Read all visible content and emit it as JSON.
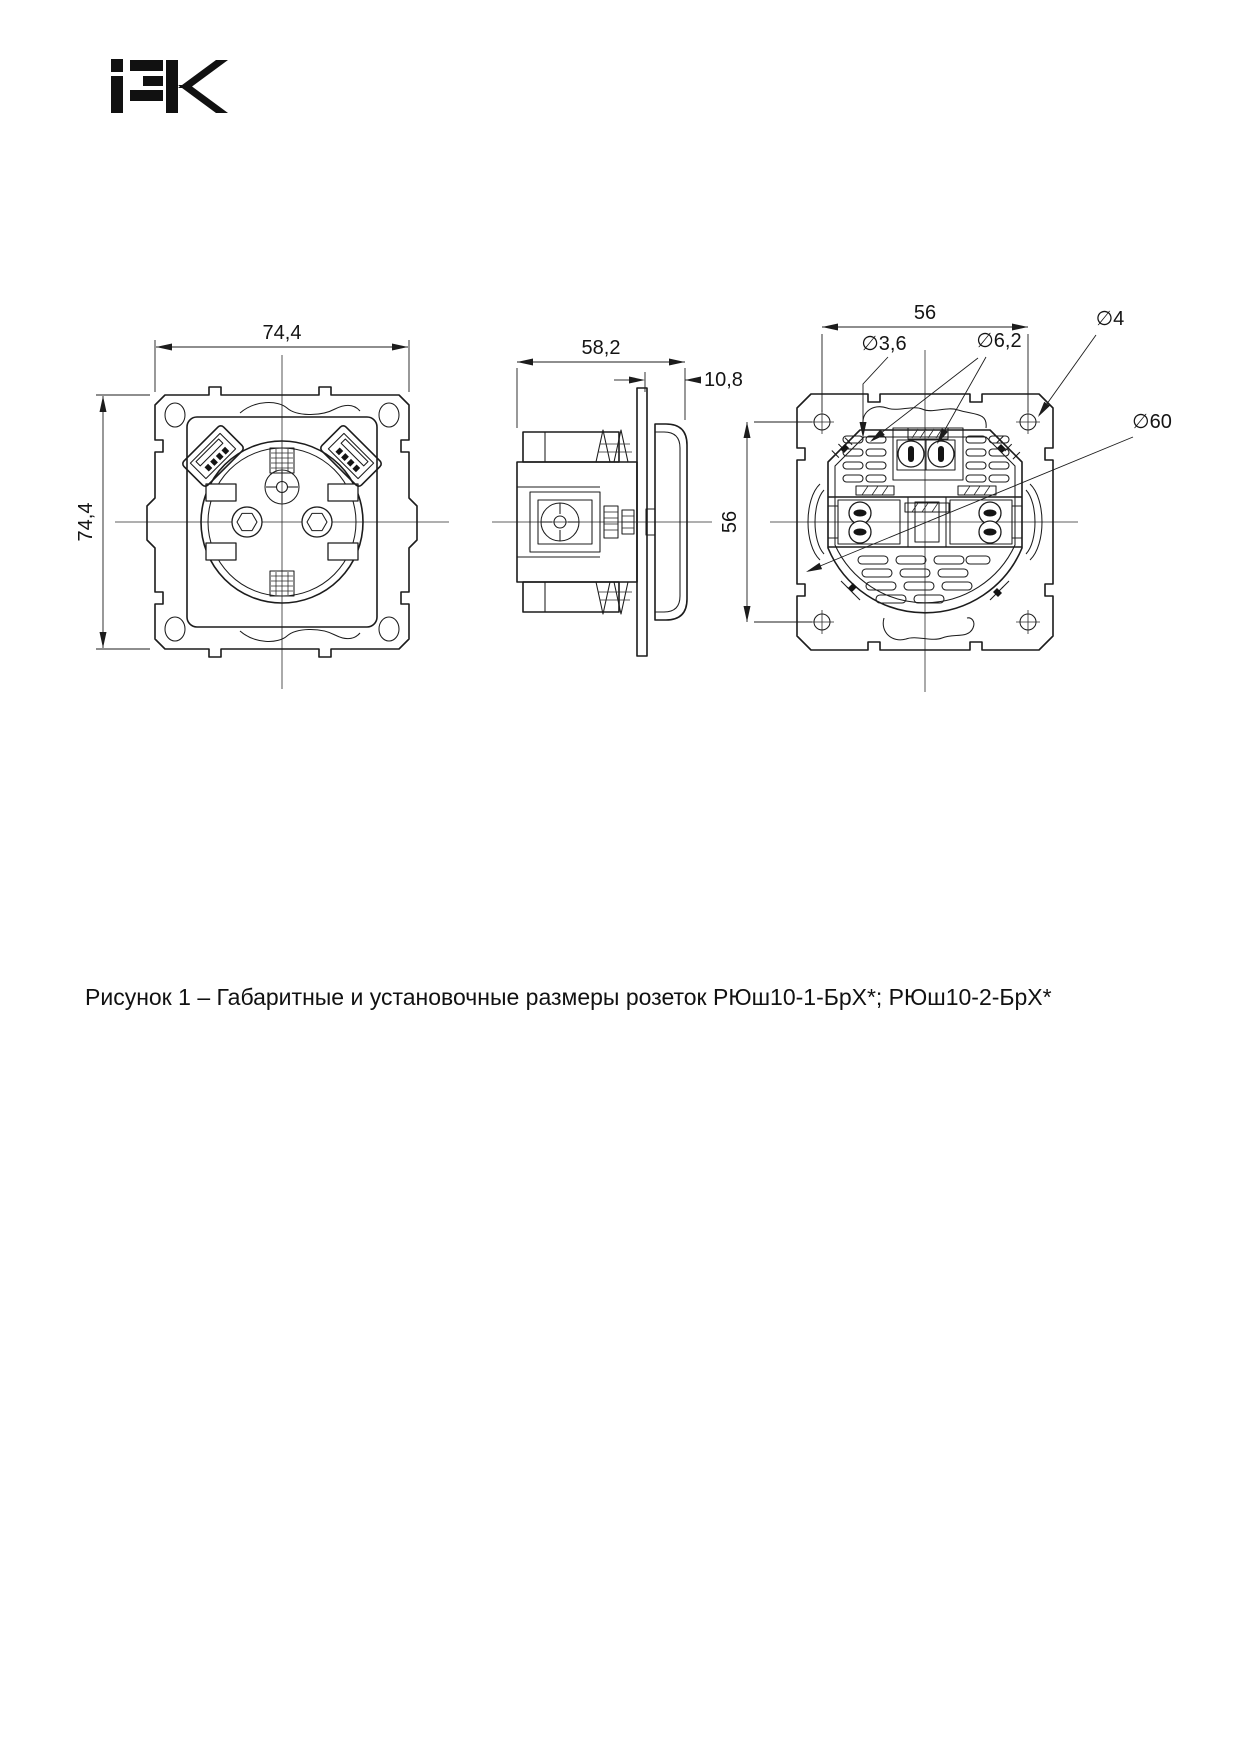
{
  "brand": {
    "name": "IEK"
  },
  "caption": "Рисунок 1 – Габаритные и установочные размеры розеток РЮш10-1-БрХ*; РЮш10-2-БрХ*",
  "front_view": {
    "width_mm": "74,4",
    "height_mm": "74,4"
  },
  "side_view": {
    "depth_mm": "58,2",
    "cover_mm": "10,8"
  },
  "back_view": {
    "mount_spacing_h_mm": "56",
    "mount_spacing_v_mm": "56",
    "claw_hole_dia": "∅3,6",
    "terminal_hole_dia": "∅6,2",
    "mount_hole_dia": "∅4",
    "body_dia": "∅60"
  }
}
